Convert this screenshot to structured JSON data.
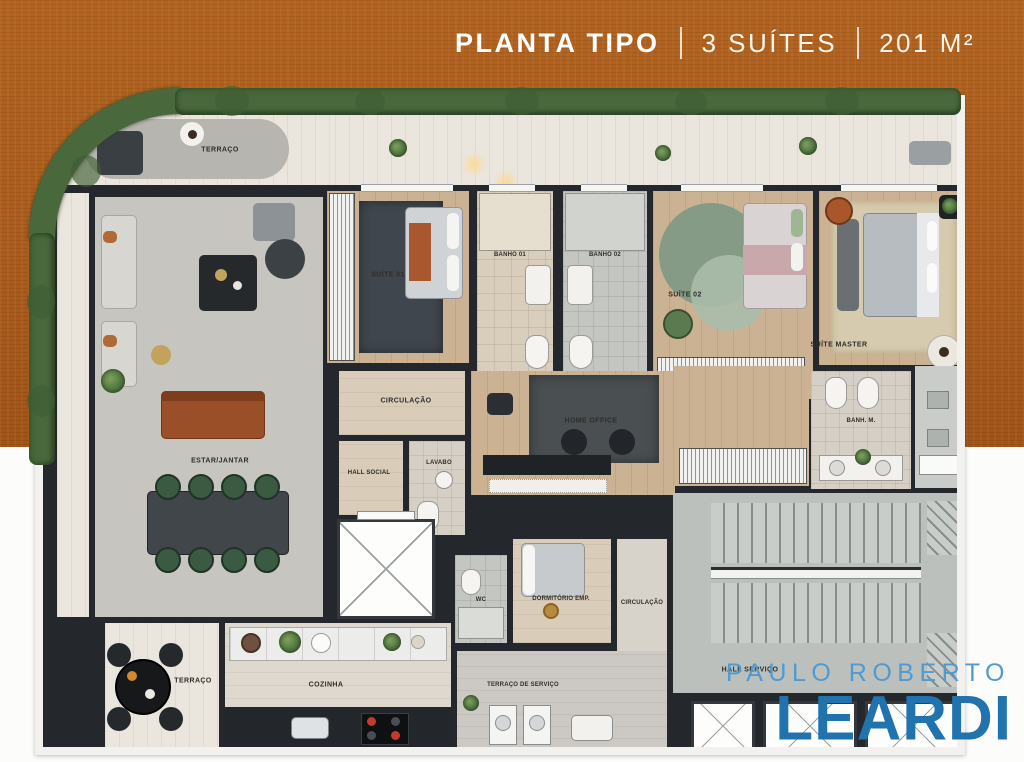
{
  "header": {
    "title": "PLANTA TIPO",
    "suites": "3 SUÍTES",
    "area": "201 M²"
  },
  "logo": {
    "top": "PAULO ROBERTO",
    "name": "LEARDI"
  },
  "rooms": {
    "terraco_superior": "TERRAÇO",
    "estar_jantar": "ESTAR/JANTAR",
    "suite_01": "SUÍTE 01",
    "banho_01": "BANHO 01",
    "banho_02": "BANHO 02",
    "suite_02": "SUÍTE 02",
    "suite_master": "SUÍTE MASTER",
    "banho_master": "BANH. M.",
    "circulacao": "CIRCULAÇÃO",
    "home_office": "HOME OFFICE",
    "hall_social": "HALL SOCIAL",
    "lavabo": "LAVABO",
    "wc": "WC",
    "dormitorio_emp": "DORMITÓRIO EMP.",
    "circulacao_servico": "CIRCULAÇÃO",
    "cozinha": "COZINHA",
    "terraco_inferior": "TERRAÇO",
    "terraco_servico": "TERRAÇO DE SERVIÇO",
    "hall_servico": "HALL SERVIÇO"
  },
  "colors": {
    "background_top": "#ab5c1d",
    "background_bottom": "#fcfcfb",
    "hedge_green": "#49683c",
    "wall_dark": "#24282c",
    "title_white": "#ffffff",
    "logo_light_blue": "#4f9bd1",
    "logo_dark_blue": "#2173ae"
  }
}
